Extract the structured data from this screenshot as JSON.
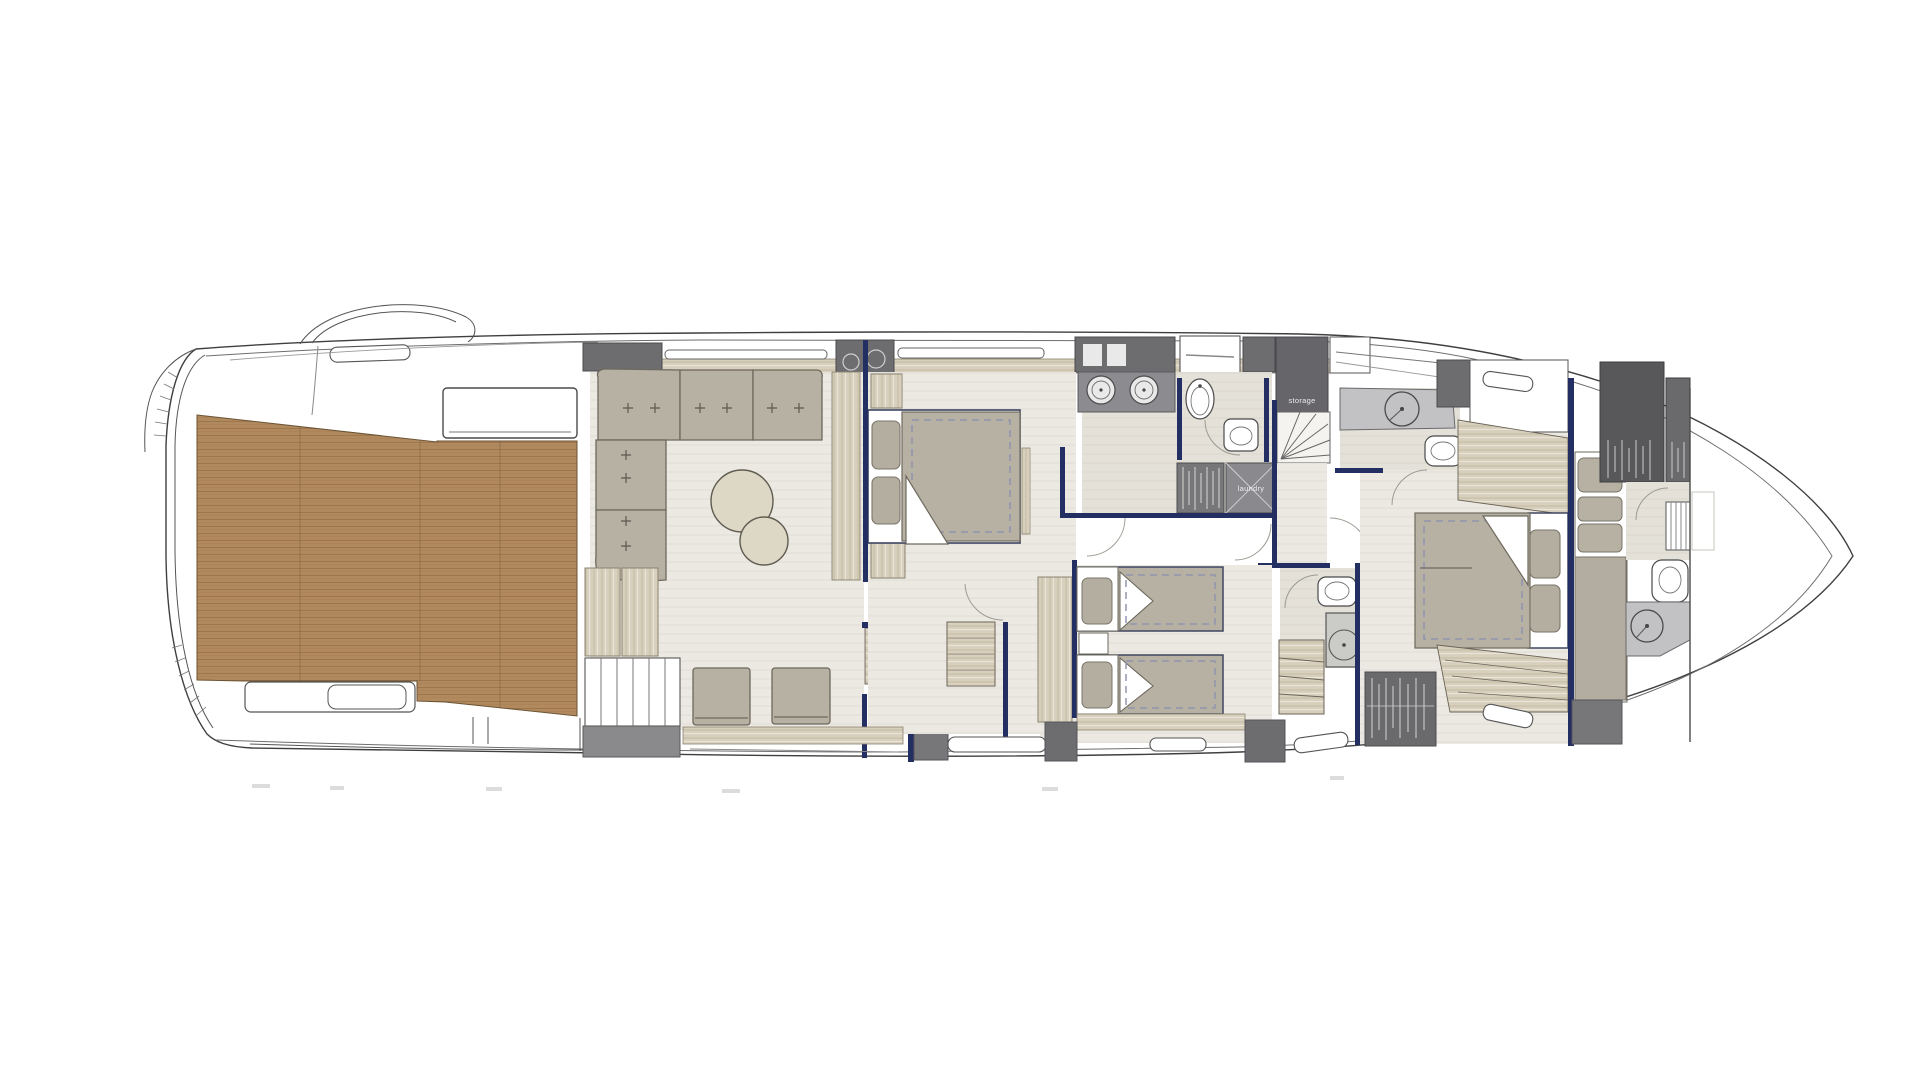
{
  "figure": {
    "kind": "yacht-deck-floor-plan",
    "orientation": "bow-right"
  },
  "labels": {
    "storage": "storage",
    "laundry": "laundry"
  },
  "palette": {
    "paper": "#ffffff",
    "teak_deck": "#b1895e",
    "teak_line": "#9c7449",
    "interior_floor": "#ebe9e2",
    "bath_floor": "#e4e1d8",
    "light_wood": "#d8d0bd",
    "furniture_beige": "#b7b1a4",
    "dark_gray_block": "#6d6d70",
    "laundry_gray": "#8a8a8e",
    "navy_wall": "#232e63",
    "hull_line": "#3f3f3f",
    "dash_blue": "#9295ad"
  }
}
